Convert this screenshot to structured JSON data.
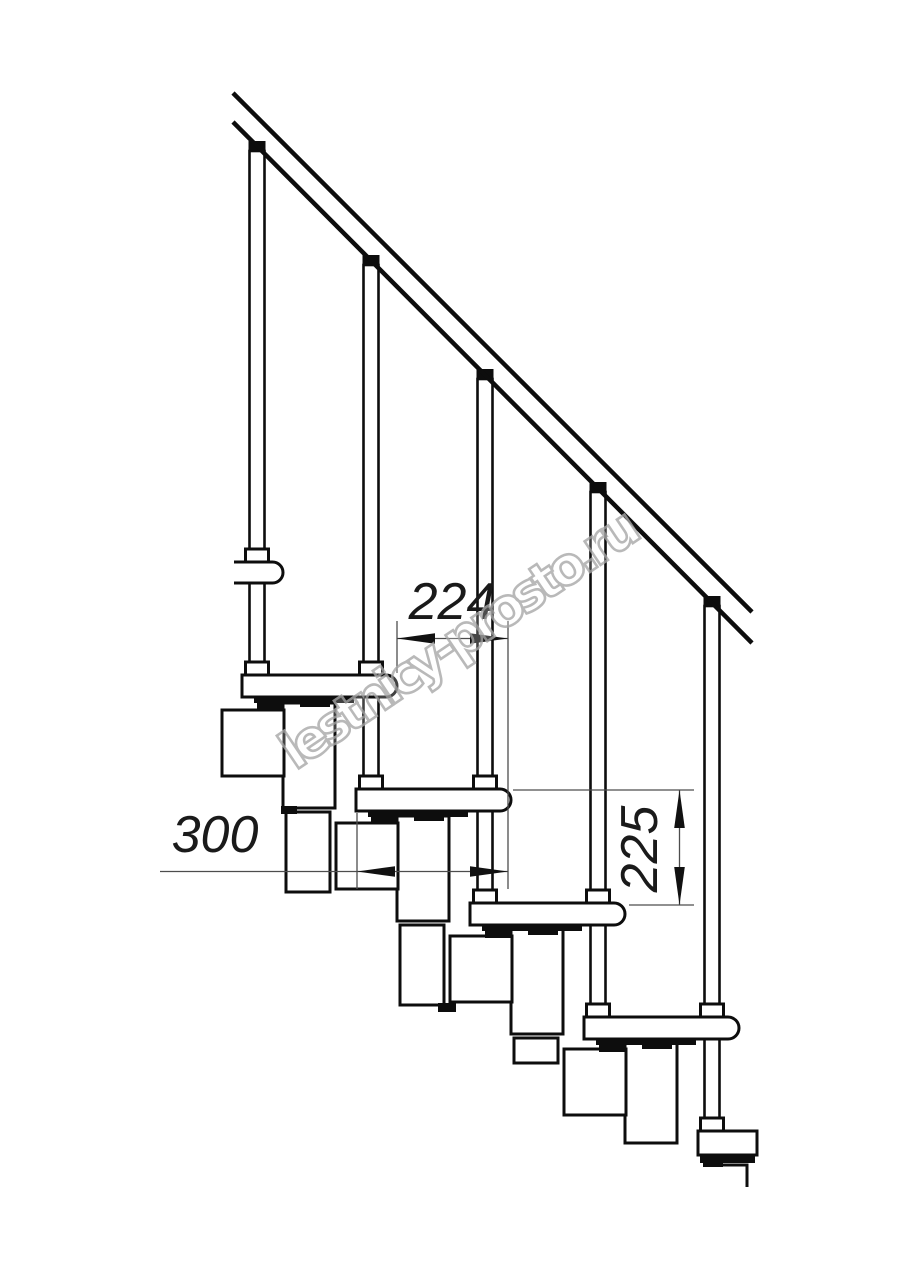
{
  "watermark": {
    "text": "lestnicy-prosto.ru"
  },
  "dimensions": {
    "tread_run": {
      "value": "224",
      "orientation": "horizontal"
    },
    "tread_depth": {
      "value": "300",
      "orientation": "horizontal"
    },
    "riser_height": {
      "value": "225",
      "orientation": "vertical"
    }
  },
  "colors": {
    "background": "#ffffff",
    "drawing_line": "#0d0d0d",
    "dimension_line": "#4d4d4d",
    "dimension_text": "#1a1a1a",
    "watermark": "#a8a8a8"
  }
}
